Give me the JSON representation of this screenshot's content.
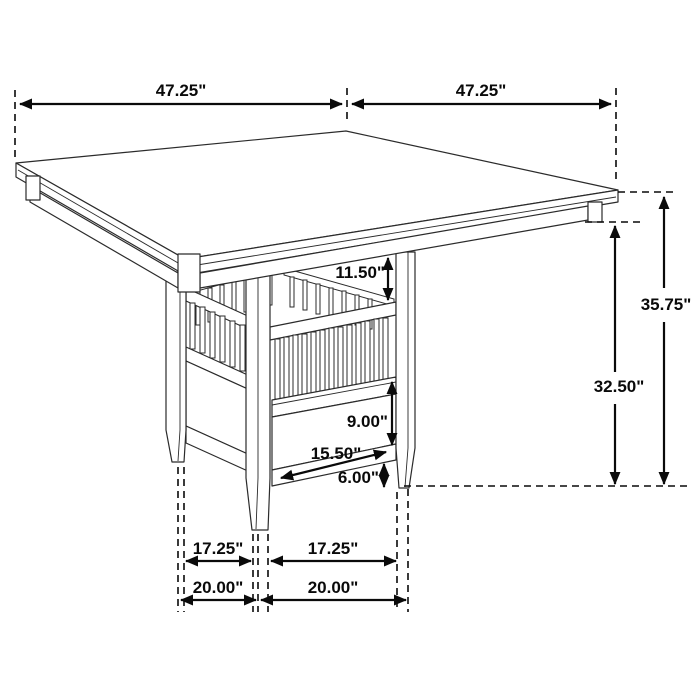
{
  "figure": {
    "type": "furniture-dimension-diagram",
    "subject": "Square counter-height dining table with slatted storage-shelf pedestal base and tapered legs",
    "units": "inches",
    "line_color": "#2b2b2b",
    "dimension_color": "#0a0a0a",
    "background_color": "#ffffff"
  },
  "dimensions": {
    "tabletop_width": "47.25\"",
    "tabletop_depth": "47.25\"",
    "overall_height": "35.75\"",
    "floor_to_apron_height": "32.50\"",
    "apron_to_shelf_gap": "11.50\"",
    "storage_box_height": "9.00\"",
    "storage_box_width": "15.50\"",
    "foot_height": "6.00\"",
    "leg_inner_span_depth": "17.25\"",
    "leg_inner_span_width": "17.25\"",
    "leg_outer_span_depth": "20.00\"",
    "leg_outer_span_width": "20.00\""
  }
}
